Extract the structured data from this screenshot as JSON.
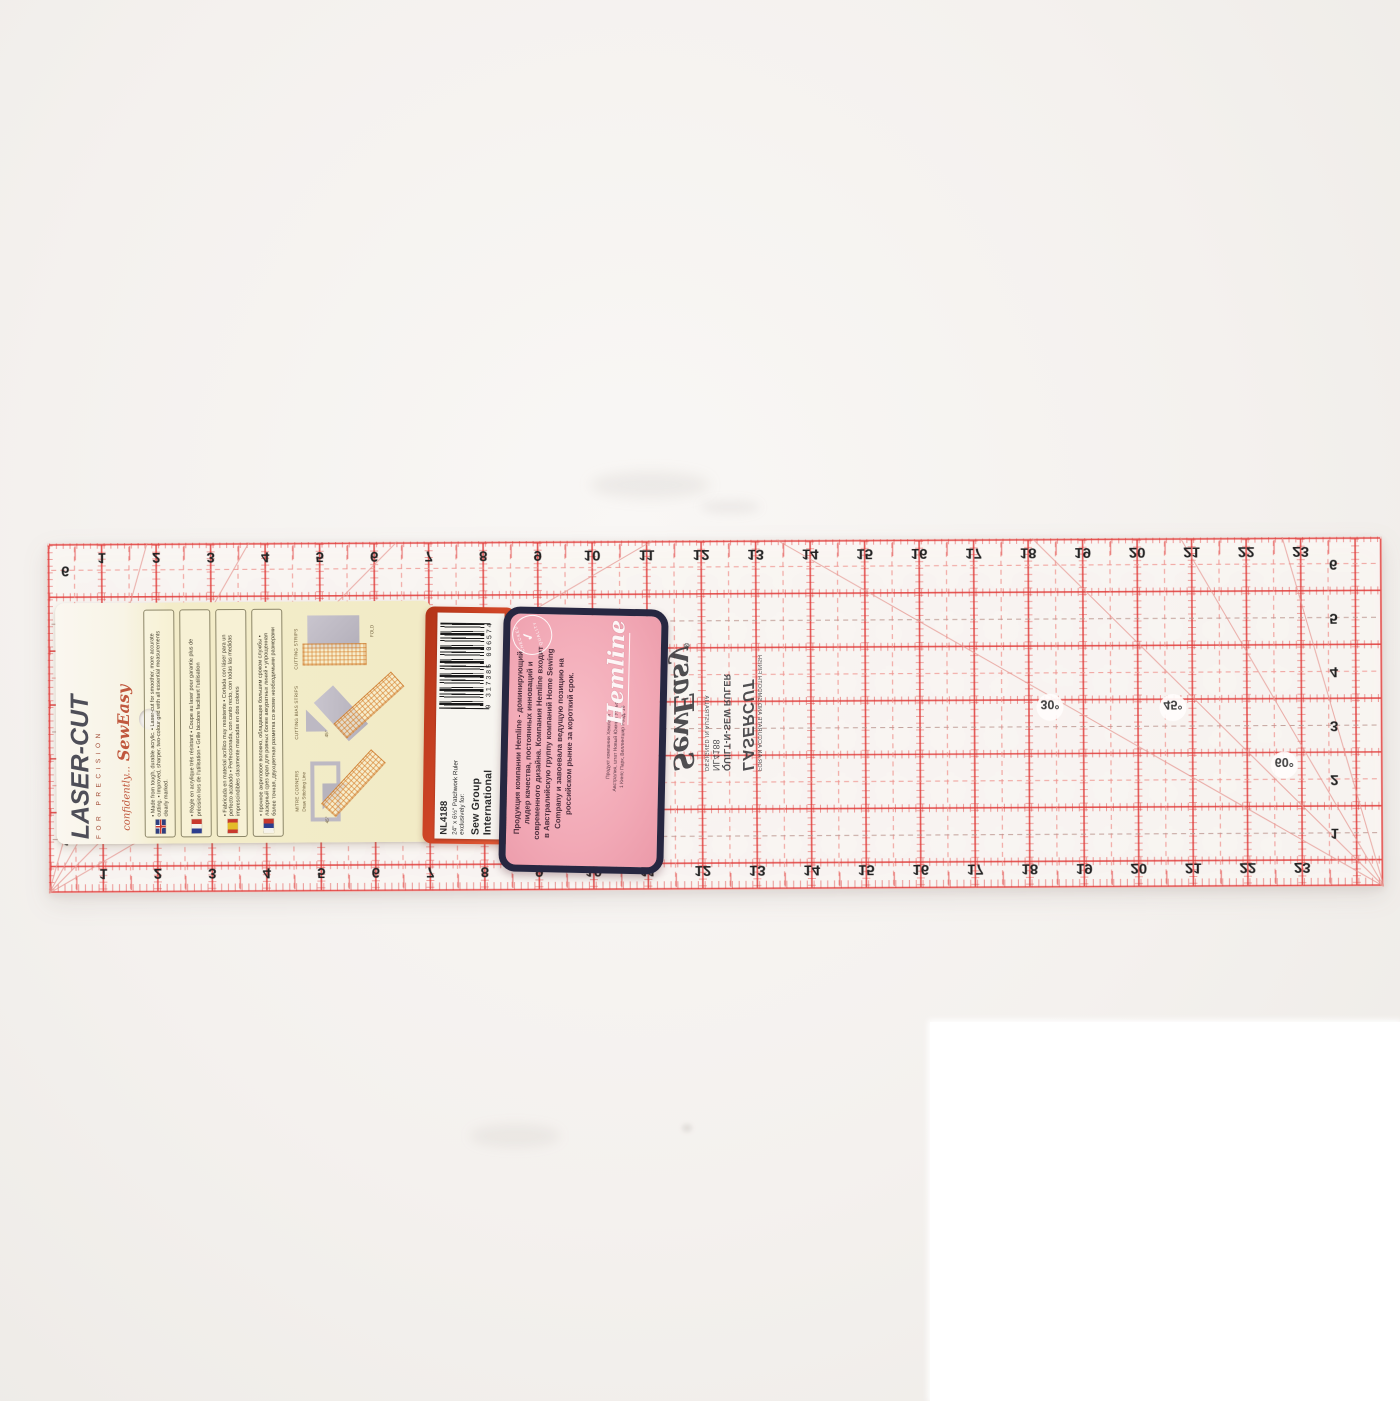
{
  "photo": {
    "background_color": "#f4f1ee",
    "description": "Product photo of a laser-cut patchwork quilting ruler with packaging, shown upside down"
  },
  "ruler": {
    "grid_color": "#e03a38",
    "dash_color": "#ee8f8a",
    "top_numbers": [
      1,
      2,
      3,
      4,
      5,
      6,
      7,
      8,
      9,
      10,
      11,
      12,
      13,
      14,
      15,
      16,
      17,
      18,
      19,
      20,
      21,
      22,
      23
    ],
    "bottom_numbers": [
      1,
      2,
      3,
      4,
      5,
      6,
      7,
      8,
      9,
      10,
      11,
      12,
      13,
      14,
      15,
      16,
      17,
      18,
      19,
      20,
      21,
      22,
      23
    ],
    "side_numbers": [
      6,
      5,
      4,
      3,
      2,
      1
    ],
    "angle_labels": [
      "30°",
      "45°",
      "60°"
    ],
    "print": {
      "logo_script": "SewEasy",
      "registered": "®",
      "title": "QUILT-N-SEW RULER",
      "code": "NL4188",
      "origin": "DESIGNED IN AUSTRALIA",
      "brand": "LASERCUT",
      "tagline": "FOR AN ACCURATE AND SMOOTH FINISH"
    }
  },
  "card": {
    "brand": "LASER-CUT",
    "brand_sub": "FOR PRECISION",
    "script_small": "confidently...",
    "script_big": "SewEasy",
    "sections": [
      {
        "flag": "uk",
        "bullets": [
          "Made from tough, durable acrylic.",
          "Laser-cut for smoother, more accurate cutting.",
          "Improved, sharper, two-colour grid with all essential measurements clearly marked."
        ]
      },
      {
        "flag": "fr",
        "bullets": [
          "Règle en acrylique très résistant",
          "Coupe au laser pour garantie plus de précision lors de l'utilisation",
          "Grille bicolore facilitant l'utilisation"
        ]
      },
      {
        "flag": "es",
        "bullets": [
          "Fabricada en material acrílico muy resistente",
          "Cortada con láser para un perfecto acabado",
          "Perfeccionada, con canto recto, con todas las medidas imprescindibles claramente marcadas en dos colores"
        ]
      },
      {
        "flag": "ru",
        "bullets": [
          "прочное акриловое волокно, обладающее большим сроком службы",
          "лазерный срез края для ровных более аккуратных линий",
          "упрощенная более точная, двухцветная разметка со всеми необходимыми размерами"
        ]
      }
    ],
    "diagrams": [
      {
        "label": "CUTTING STRIPS",
        "note": "FOLD"
      },
      {
        "label": "CUTTING BIAS STRIPS",
        "note": "45°"
      },
      {
        "label": "MITRE CORNERS",
        "note": "Draw Stitching Line",
        "angle": "45°"
      }
    ]
  },
  "red_label": {
    "sticker": {
      "code": "NL4188",
      "size_line": "24\" x 6½\" Patchwork Ruler",
      "for_line": "exclusively for:",
      "company": "Sew Group International",
      "ru_line": "Продукт компании Хемлайн",
      "barcode_digits": "9 317385 006574"
    }
  },
  "pink_label": {
    "paragraph": "Продукция компании Hemline - доминирующий лидер качества, постоянных инноваций и современного дизайна. Компания Hemline входит в Австралийскую группу компаний Home Sewing Company и завоевала ведущую позицию на российском рынке за короткий срок.",
    "address_lines": [
      "Продукт компании Хемлайн",
      "Австралия, штат Новый Южный Уэльс",
      "1 Кингс Парк, Веллингшир Роад, 16"
    ],
    "brand_script": "Hemline",
    "stamp": {
      "top": "CHECKED",
      "check": "✓",
      "bottom": "QUALITY"
    },
    "border_color": "#272741",
    "bg_color": "#f2a9b6"
  }
}
